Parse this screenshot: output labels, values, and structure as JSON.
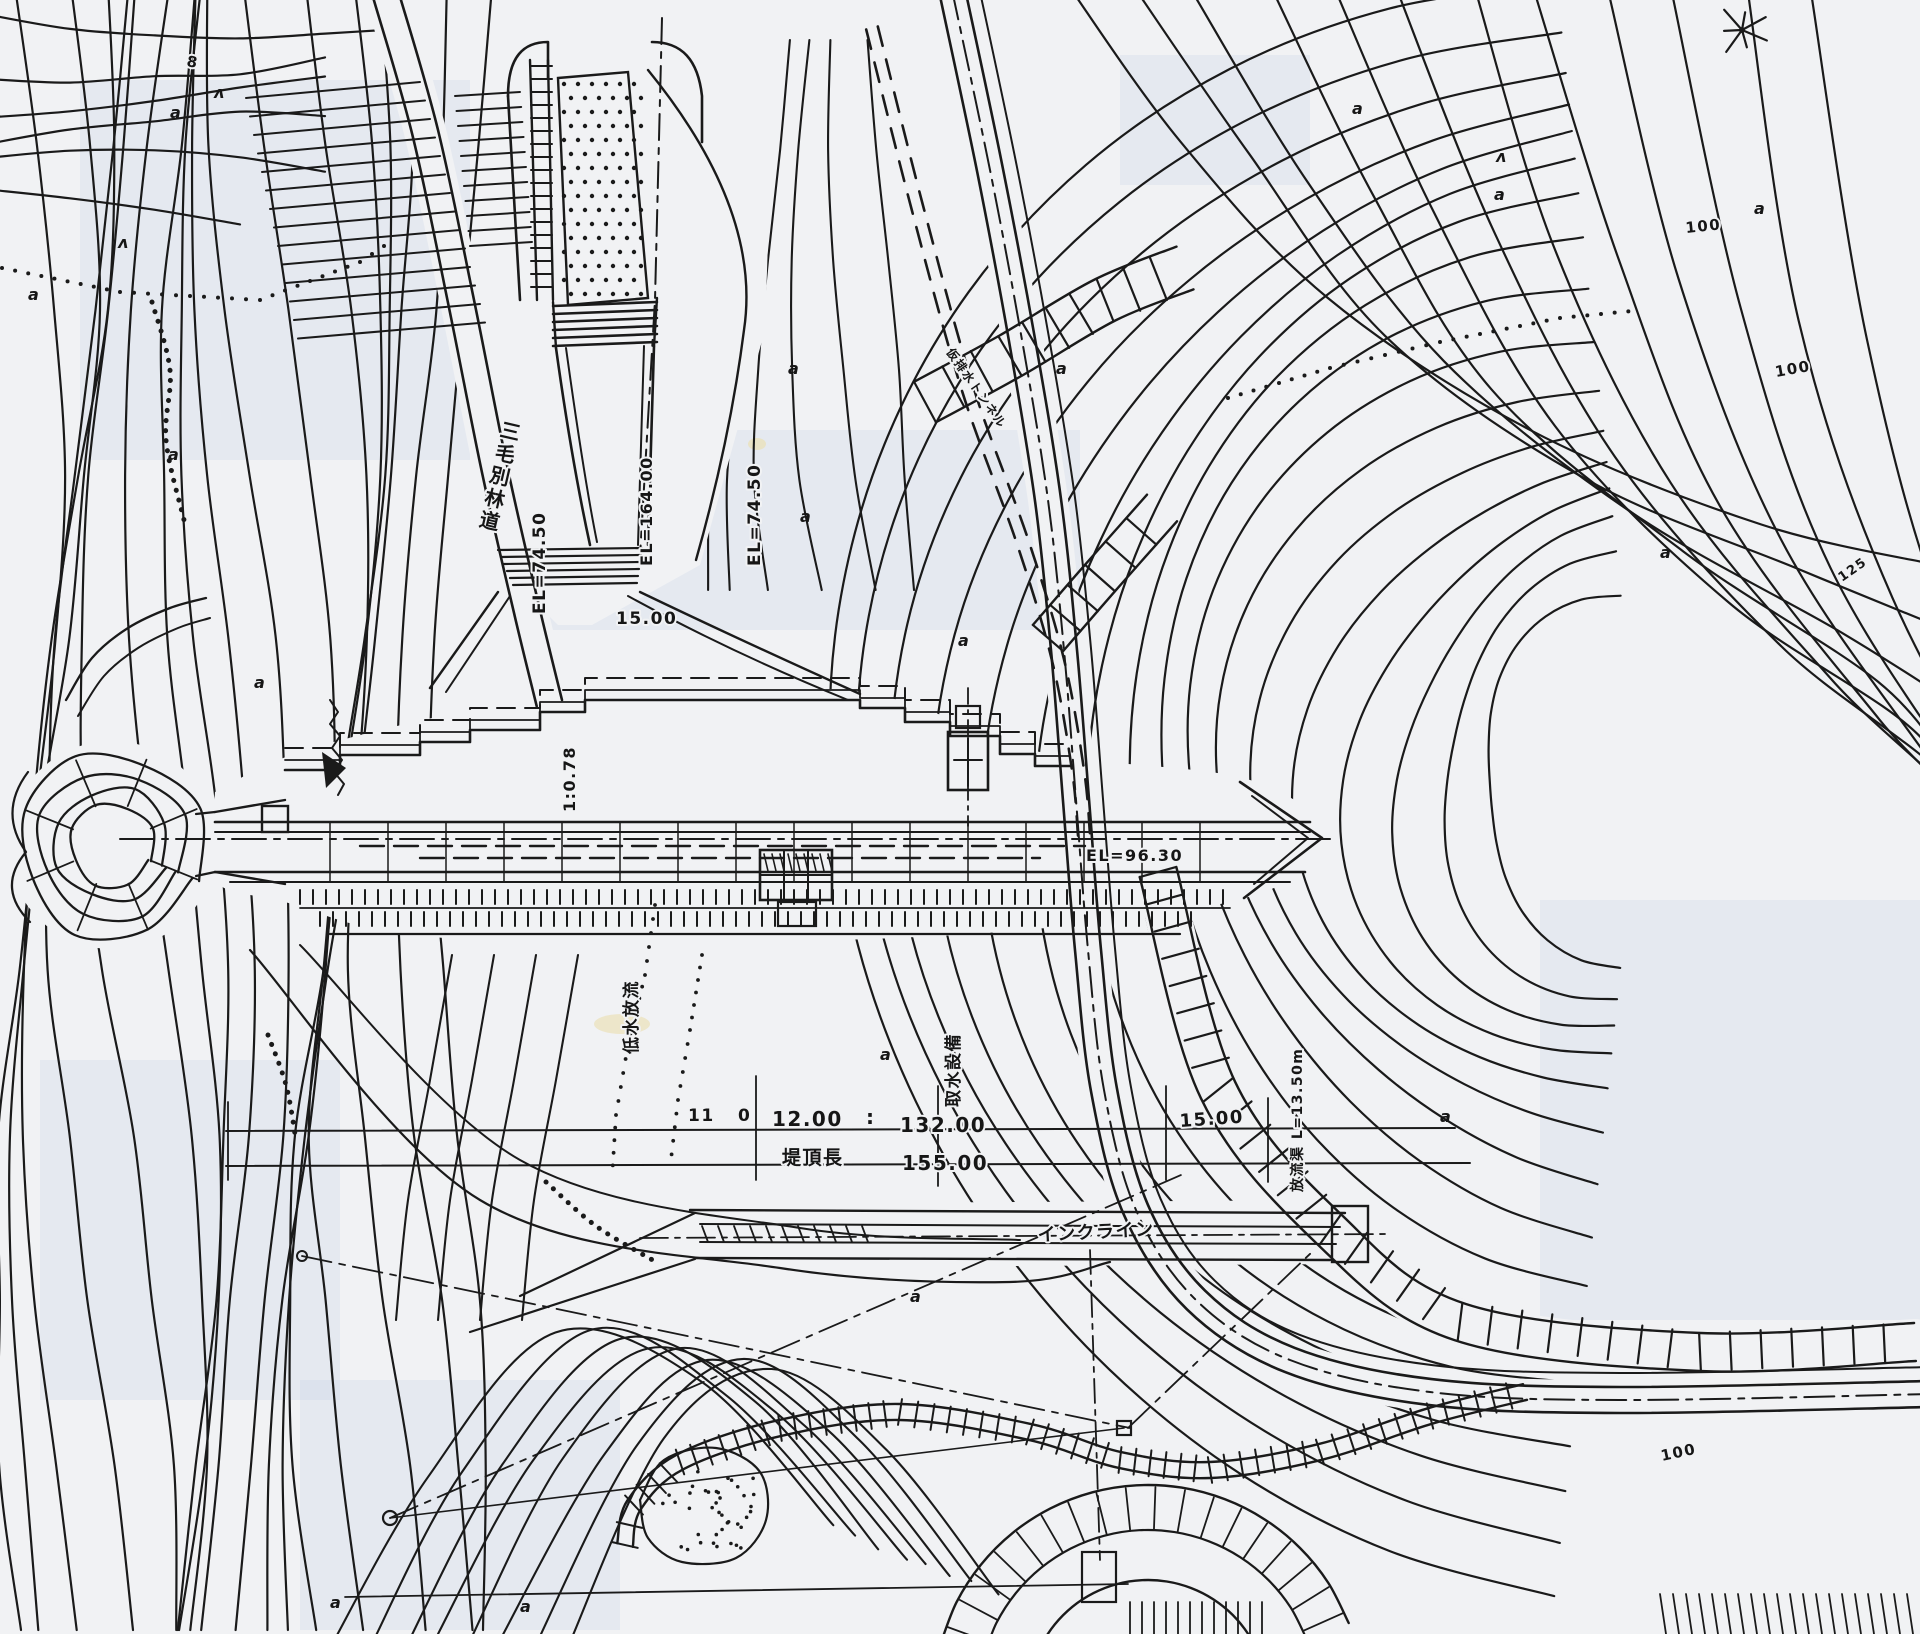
{
  "drawing": {
    "kind_label": "dam site plan (scanned)",
    "colors": {
      "paper": "#f1f2f4",
      "ink": "#1a1a1a",
      "tint": "rgba(184,200,223,0.20)"
    }
  },
  "labels": [
    {
      "id": "road-name",
      "text": "三毛別林道",
      "x": 499,
      "y": 436,
      "rotate": 13,
      "size": 20,
      "vertical": true
    },
    {
      "id": "el-left",
      "text": "EL=74.50",
      "x": 545,
      "y": 614,
      "rotate": -90,
      "size": 17
    },
    {
      "id": "el-center",
      "text": "EL=164.00",
      "x": 652,
      "y": 566,
      "rotate": -90,
      "size": 16
    },
    {
      "id": "el-right",
      "text": "EL=74.50",
      "x": 760,
      "y": 566,
      "rotate": -90,
      "size": 17
    },
    {
      "id": "dim-15-upper",
      "text": "15.00",
      "x": 616,
      "y": 624,
      "rotate": 0,
      "size": 17
    },
    {
      "id": "slope-ratio",
      "text": "1:0.78",
      "x": 575,
      "y": 812,
      "rotate": -90,
      "size": 16
    },
    {
      "id": "low-water-outlet",
      "text": "低水放流",
      "x": 637,
      "y": 1054,
      "rotate": -90,
      "size": 17
    },
    {
      "id": "intake-facility",
      "text": "取水設備",
      "x": 959,
      "y": 1107,
      "rotate": -90,
      "size": 17
    },
    {
      "id": "el-crest",
      "text": "EL=96.30",
      "x": 1086,
      "y": 861,
      "rotate": 0,
      "size": 16
    },
    {
      "id": "dim-11",
      "text": "11",
      "x": 688,
      "y": 1121,
      "rotate": 0,
      "size": 17
    },
    {
      "id": "dim-0",
      "text": "0",
      "x": 738,
      "y": 1121,
      "rotate": 0,
      "size": 17
    },
    {
      "id": "dim-12",
      "text": "12.00",
      "x": 772,
      "y": 1126,
      "rotate": 0,
      "size": 20
    },
    {
      "id": "dim-colon",
      "text": ":",
      "x": 866,
      "y": 1124,
      "rotate": 0,
      "size": 20
    },
    {
      "id": "dim-132",
      "text": "132.00",
      "x": 900,
      "y": 1132,
      "rotate": 0,
      "size": 20
    },
    {
      "id": "dim-15-right",
      "text": "15.00",
      "x": 1180,
      "y": 1127,
      "rotate": -4,
      "size": 18
    },
    {
      "id": "crest-length",
      "text": "堤頂長",
      "x": 782,
      "y": 1164,
      "rotate": 0,
      "size": 19
    },
    {
      "id": "dim-155",
      "text": "155.00",
      "x": 902,
      "y": 1170,
      "rotate": 0,
      "size": 20
    },
    {
      "id": "incline",
      "text": "インクライン",
      "x": 1038,
      "y": 1241,
      "rotate": -3,
      "size": 18
    },
    {
      "id": "outlet-channel",
      "text": "放流渠 L=13.50m",
      "x": 1302,
      "y": 1192,
      "rotate": -90,
      "size": 14
    },
    {
      "id": "diversion-tunnel",
      "text": "仮排水トンネル",
      "x": 946,
      "y": 352,
      "rotate": 55,
      "size": 12
    },
    {
      "id": "contour-100-a",
      "text": "100",
      "x": 1686,
      "y": 233,
      "rotate": -6,
      "size": 15
    },
    {
      "id": "contour-100-b",
      "text": "100",
      "x": 1776,
      "y": 377,
      "rotate": -10,
      "size": 15
    },
    {
      "id": "contour-125",
      "text": "125",
      "x": 1842,
      "y": 582,
      "rotate": -35,
      "size": 13
    },
    {
      "id": "contour-100-c",
      "text": "100",
      "x": 1662,
      "y": 1461,
      "rotate": -12,
      "size": 15
    },
    {
      "id": "spot-8",
      "text": "8",
      "x": 186,
      "y": 66,
      "rotate": 10,
      "size": 15
    }
  ],
  "symbols": [
    {
      "glyph": "a",
      "x": 170,
      "y": 118
    },
    {
      "glyph": "a",
      "x": 28,
      "y": 300
    },
    {
      "glyph": "a",
      "x": 168,
      "y": 460
    },
    {
      "glyph": "a",
      "x": 254,
      "y": 688
    },
    {
      "glyph": "a",
      "x": 788,
      "y": 374
    },
    {
      "glyph": "a",
      "x": 800,
      "y": 522
    },
    {
      "glyph": "a",
      "x": 958,
      "y": 646
    },
    {
      "glyph": "a",
      "x": 880,
      "y": 1060
    },
    {
      "glyph": "a",
      "x": 910,
      "y": 1302
    },
    {
      "glyph": "a",
      "x": 520,
      "y": 1612
    },
    {
      "glyph": "a",
      "x": 1440,
      "y": 1122
    },
    {
      "glyph": "a",
      "x": 1660,
      "y": 558
    },
    {
      "glyph": "a",
      "x": 1754,
      "y": 214
    },
    {
      "glyph": "a",
      "x": 1494,
      "y": 200
    },
    {
      "glyph": "a",
      "x": 1352,
      "y": 114
    },
    {
      "glyph": "a",
      "x": 1056,
      "y": 374
    },
    {
      "glyph": "a",
      "x": 330,
      "y": 1608
    },
    {
      "glyph": "ʌ",
      "x": 214,
      "y": 98
    },
    {
      "glyph": "ʌ",
      "x": 1496,
      "y": 162
    },
    {
      "glyph": "ʌ",
      "x": 118,
      "y": 248
    }
  ]
}
